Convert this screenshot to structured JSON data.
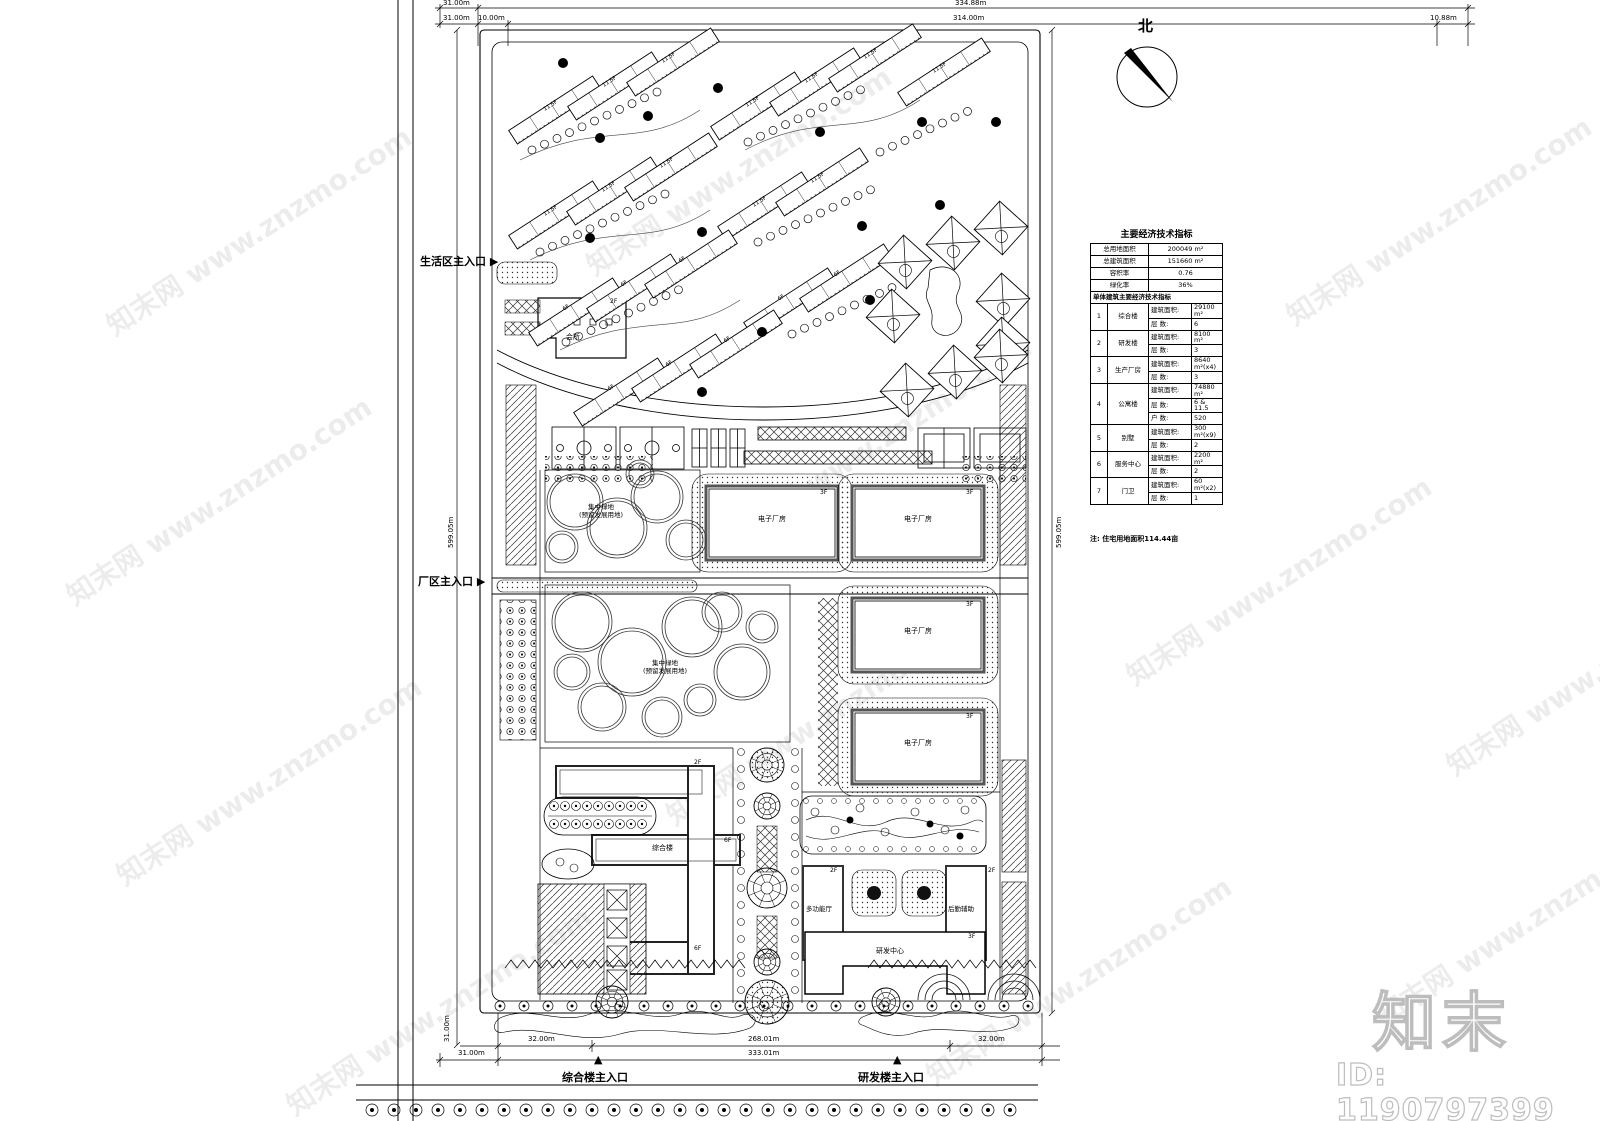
{
  "north": {
    "label": "北"
  },
  "watermark": {
    "text": "知末网 www.znzmo.com",
    "logo": "知末",
    "id_text": "ID: 1190797399"
  },
  "dims": {
    "d31": "31.00m",
    "d334": "334.88m",
    "d10": "10.00m",
    "d314": "314.00m",
    "d1088": "10.88m",
    "d599l": "599.05m",
    "d599r": "599.05m",
    "d32l": "32.00m",
    "d268": "268.01m",
    "d32r": "32.00m",
    "d31b": "31.00m",
    "d333": "333.01m",
    "d31v": "31.00m"
  },
  "entrances": {
    "living": "生活区主入口",
    "factory": "厂区主入口",
    "complex": "综合楼主入口",
    "rnd": "研发楼主入口",
    "arrow_right": "▶",
    "arrow_up": "▲"
  },
  "plan": {
    "clubhouse": "会所",
    "factory_label": "电子厂房",
    "green_line1": "集中绿地",
    "green_line2": "(预留发展用地)",
    "complex_label": "综合楼",
    "multifunction": "多功能厅",
    "logistics": "后勤辅助",
    "rnd_center": "研发中心",
    "floors": {
      "f115": "11.5F",
      "f6": "6F",
      "f3": "3F",
      "f2": "2F"
    }
  },
  "table": {
    "title": "主要经济技术指标",
    "summary": [
      {
        "label": "总用地面积",
        "value": "200049 m²"
      },
      {
        "label": "总建筑面积",
        "value": "151660 m²"
      },
      {
        "label": "容积率",
        "value": "0.76"
      },
      {
        "label": "绿化率",
        "value": "36%"
      }
    ],
    "subheader": "单体建筑主要经济技术指标",
    "items": [
      {
        "no": "1",
        "name": "综合楼",
        "rows": [
          [
            "建筑面积:",
            "29100 m²"
          ],
          [
            "层  数:",
            "6"
          ]
        ]
      },
      {
        "no": "2",
        "name": "研发楼",
        "rows": [
          [
            "建筑面积:",
            "8100 m²"
          ],
          [
            "层  数:",
            "3"
          ]
        ]
      },
      {
        "no": "3",
        "name": "生产厂房",
        "rows": [
          [
            "建筑面积:",
            "8640 m²(x4)"
          ],
          [
            "层  数:",
            "3"
          ]
        ]
      },
      {
        "no": "4",
        "name": "公寓楼",
        "rows": [
          [
            "建筑面积:",
            "74880 m²"
          ],
          [
            "层  数:",
            "6 & 11.5"
          ],
          [
            "户  数:",
            "520"
          ]
        ]
      },
      {
        "no": "5",
        "name": "别墅",
        "rows": [
          [
            "建筑面积:",
            "300 m²(x9)"
          ],
          [
            "层  数:",
            "2"
          ]
        ]
      },
      {
        "no": "6",
        "name": "服务中心",
        "rows": [
          [
            "建筑面积:",
            "2200 m²"
          ],
          [
            "层  数:",
            "2"
          ]
        ]
      },
      {
        "no": "7",
        "name": "门卫",
        "rows": [
          [
            "建筑面积:",
            "60 m²(x2)"
          ],
          [
            "层  数:",
            "1"
          ]
        ]
      }
    ],
    "note": "注: 住宅用地面积114.44亩"
  }
}
